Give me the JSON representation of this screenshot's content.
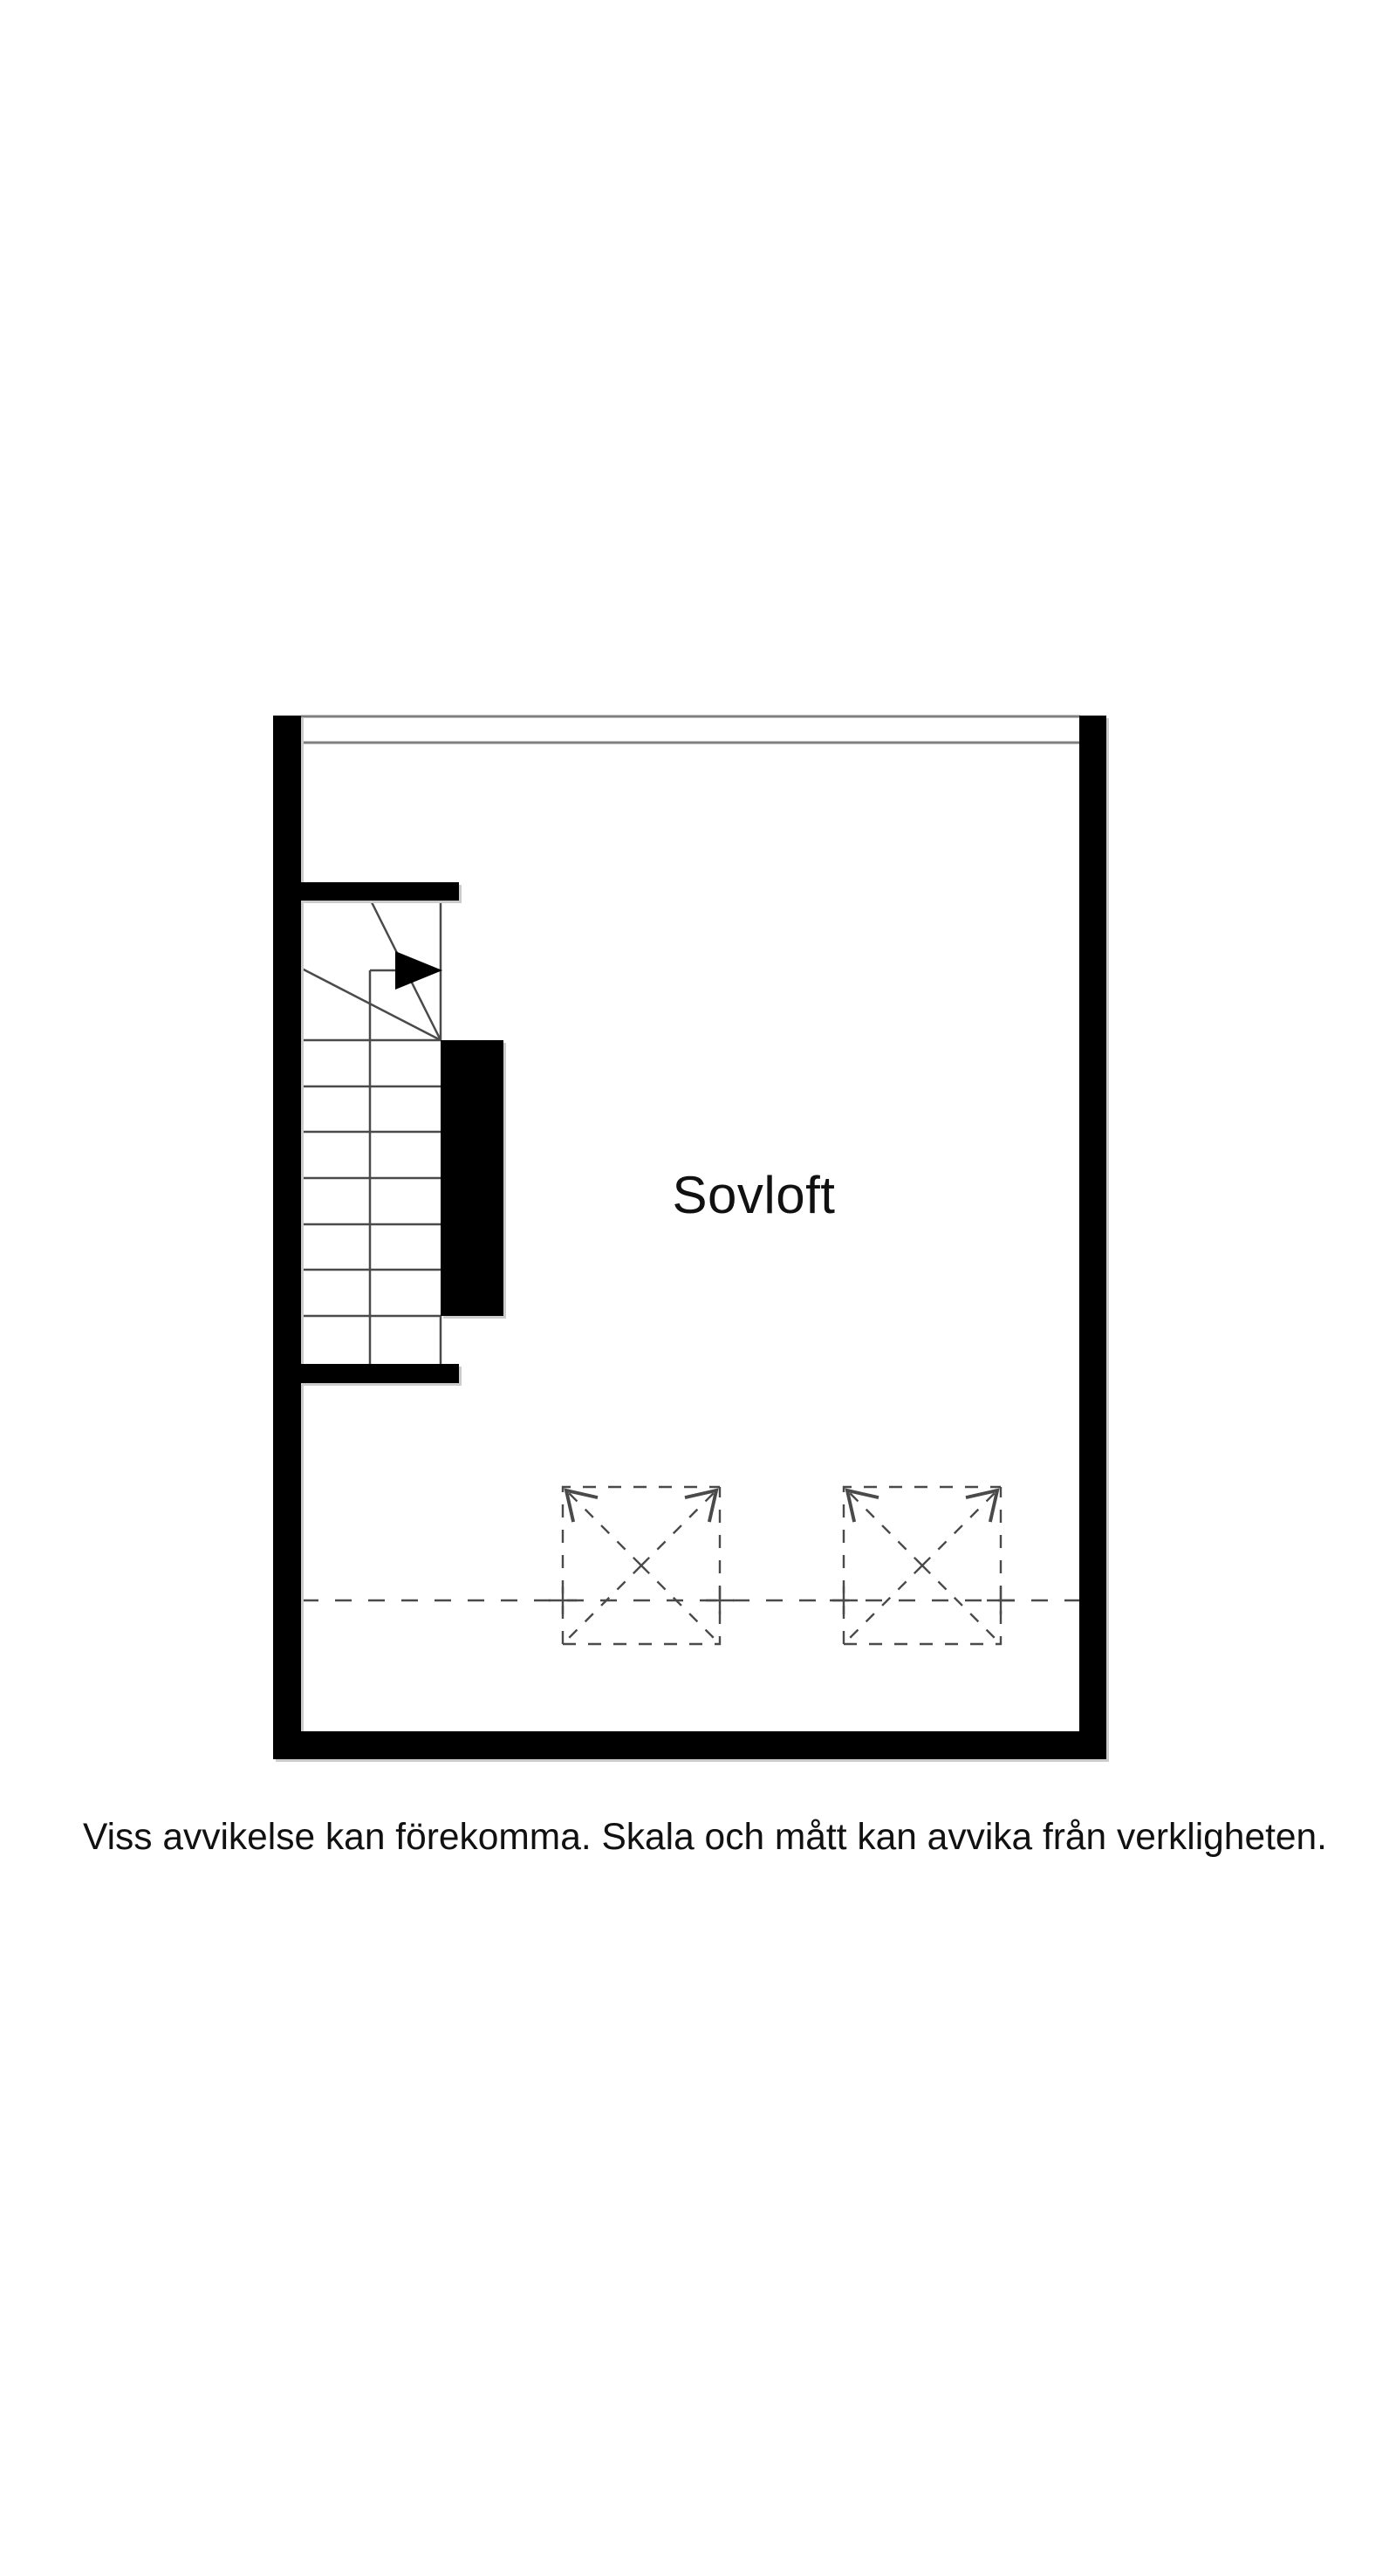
{
  "floorplan": {
    "room_label": "Sovloft",
    "disclaimer": "Viss avvikelse kan förekomma. Skala och mått kan avvika från verkligheten.",
    "colors": {
      "wall": "#000000",
      "line": "#4a4a4a",
      "opening_line": "#7f7f7f",
      "background": "#ffffff",
      "text": "#111111"
    },
    "symbols": {
      "stair_arrow_icon": "solid right-pointing triangle (direction of travel)",
      "skylight_icon": "dashed square with X and corner arrows",
      "skylight_count": 2
    }
  }
}
